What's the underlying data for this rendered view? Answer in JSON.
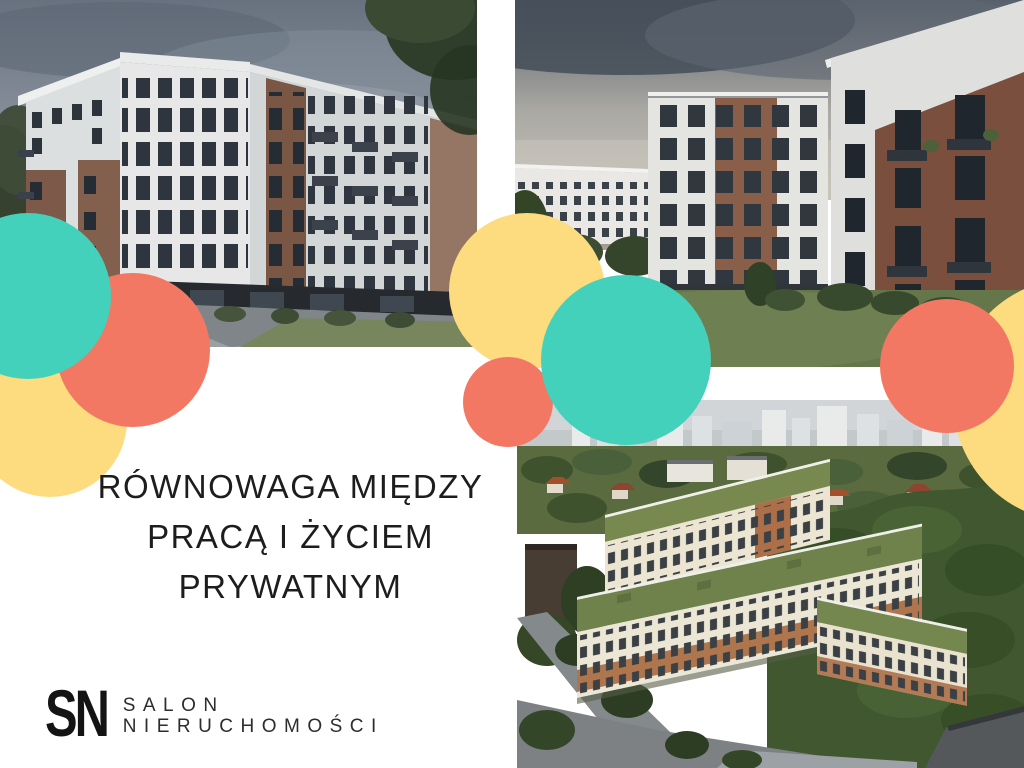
{
  "heading": {
    "full_text": "RÓWNOWAGA MIĘDZY PRACĄ I ŻYCIEM PRYWATNYM",
    "lines": [
      "RÓWNOWAGA MIĘDZY",
      "PRACĄ I ŻYCIEM",
      "PRYWATNYM"
    ]
  },
  "logo": {
    "monogram": "SN",
    "name_line1": "SALON",
    "name_line2": "NIERUCHOMOŚCI"
  },
  "palette": {
    "teal": "#43D1BB",
    "coral": "#F27863",
    "yellow": "#FCDC7F",
    "heading_text": "#1D1D1D",
    "logo_text": "#2D2D2D",
    "background": "#FFFFFF"
  },
  "photos": {
    "top_left_alt": "Street view render of a modern white apartment building with brick sections and balconies at dusk",
    "top_right_alt": "Courtyard between white and red-brick apartment buildings with lawn",
    "bottom_right_alt": "Aerial view of a housing estate with green roofs beside a forest and city skyline"
  }
}
